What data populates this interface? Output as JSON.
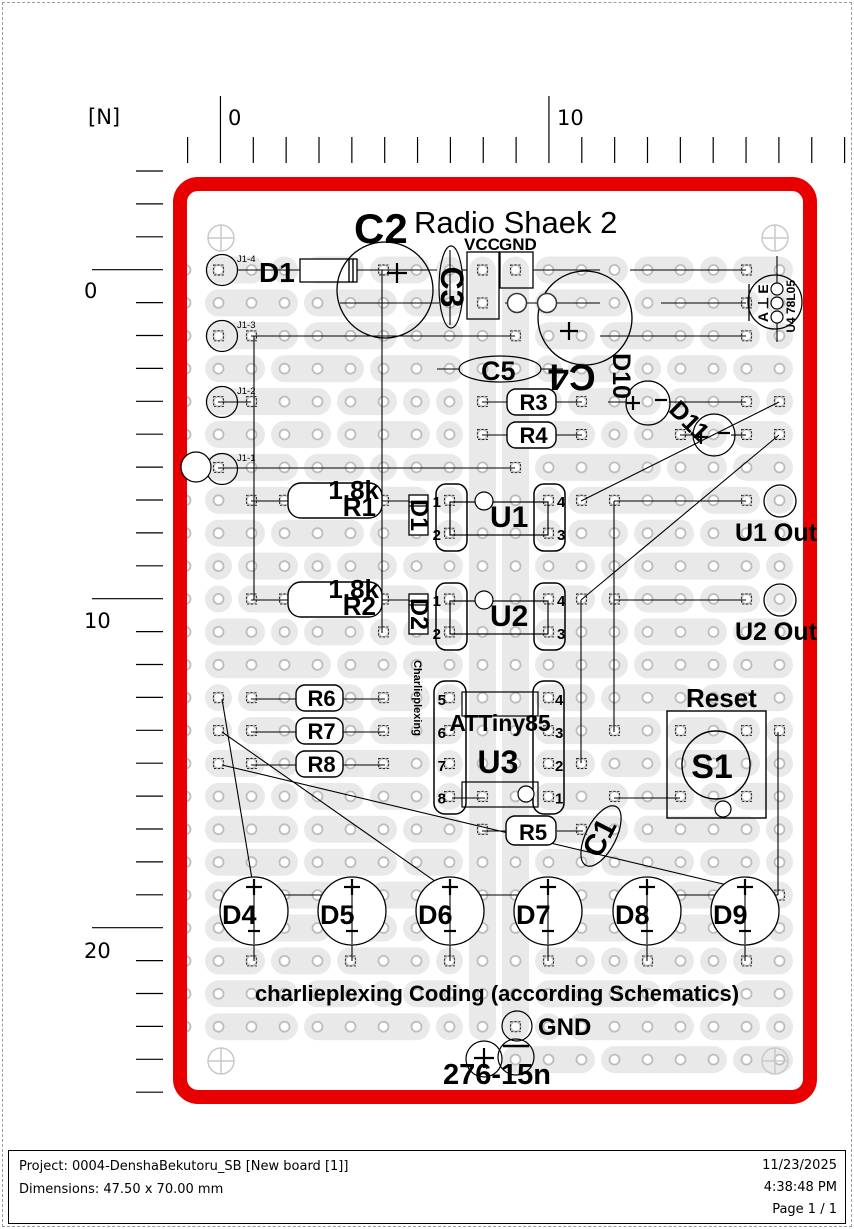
{
  "page": {
    "footer": {
      "project": "Project: 0004-DenshaBekutoru_SB [New board [1]]",
      "dimensions": "Dimensions: 47.50 x 70.00 mm",
      "date": "11/23/2025",
      "time": "4:38:48 PM",
      "page": "Page 1 / 1"
    }
  },
  "ruler": {
    "unit": "[N]",
    "top": [
      {
        "x": 221,
        "t": "0"
      },
      {
        "x": 550,
        "t": "10"
      }
    ],
    "left": [
      {
        "y": 270,
        "t": "0"
      },
      {
        "y": 600,
        "t": "10"
      },
      {
        "y": 930,
        "t": "20"
      }
    ]
  },
  "board": {
    "colors": {
      "border": "#e80000",
      "strip": "#e9e9e9",
      "hole_ring": "#bdbdbd"
    },
    "labels": [
      {
        "t": "Radio Shaek 2",
        "x": 414,
        "y": 233,
        "s": 31,
        "w": 400,
        "n": "board-title"
      },
      {
        "t": "VCC",
        "x": 464,
        "y": 250,
        "s": 17,
        "n": "vcc-header-label"
      },
      {
        "t": "GND",
        "x": 499,
        "y": 250,
        "s": 17,
        "n": "gnd-header-label"
      },
      {
        "t": "C2",
        "x": 354,
        "y": 243,
        "s": 42,
        "n": "ref-C2"
      },
      {
        "t": "C3",
        "x": 452,
        "y": 287,
        "s": 32,
        "r": 90,
        "n": "ref-C3"
      },
      {
        "t": "C5",
        "x": 481,
        "y": 380,
        "s": 27,
        "n": "ref-C5"
      },
      {
        "t": "C4",
        "x": 572,
        "y": 377,
        "s": 37,
        "r": 180,
        "n": "ref-C4"
      },
      {
        "t": "D10",
        "x": 621,
        "y": 376,
        "s": 25,
        "r": 90,
        "n": "ref-D10"
      },
      {
        "t": "D11",
        "x": 689,
        "y": 421,
        "s": 25,
        "r": 45,
        "n": "ref-D11"
      },
      {
        "t": "D1",
        "x": 259,
        "y": 282,
        "s": 28,
        "n": "ref-D1"
      },
      {
        "t": "D1",
        "x": 419,
        "y": 515,
        "s": 25,
        "r": 90,
        "n": "ref-D1-small"
      },
      {
        "t": "D2",
        "x": 419,
        "y": 614,
        "s": 25,
        "r": 90,
        "n": "ref-D2-small"
      },
      {
        "t": "C1",
        "x": 600,
        "y": 838,
        "s": 30,
        "r": -63,
        "n": "ref-C1"
      },
      {
        "t": "charlieplexing Coding (according Schematics)",
        "x": 497,
        "y": 1001,
        "s": 22,
        "a": "m",
        "n": "coding-note"
      },
      {
        "t": "GND",
        "x": 538,
        "y": 1035,
        "s": 24,
        "n": "gnd-pad-label"
      },
      {
        "t": "276-15n",
        "x": 443,
        "y": 1084,
        "s": 29,
        "n": "battery-part-label"
      }
    ],
    "resistors": [
      {
        "ref": "R1",
        "value": "1.8k",
        "x": 288,
        "y": 483,
        "w": 94,
        "h": 35,
        "big": true
      },
      {
        "ref": "R2",
        "value": "1.8k",
        "x": 288,
        "y": 582,
        "w": 94,
        "h": 35,
        "big": true
      },
      {
        "ref": "R3",
        "x": 507,
        "y": 389,
        "w": 49,
        "h": 26
      },
      {
        "ref": "R4",
        "x": 507,
        "y": 422,
        "w": 49,
        "h": 26
      },
      {
        "ref": "R5",
        "x": 506,
        "y": 816,
        "w": 50,
        "h": 29
      },
      {
        "ref": "R6",
        "x": 296,
        "y": 685,
        "w": 47,
        "h": 26
      },
      {
        "ref": "R7",
        "x": 296,
        "y": 718,
        "w": 47,
        "h": 26
      },
      {
        "ref": "R8",
        "x": 296,
        "y": 751,
        "w": 47,
        "h": 26
      }
    ],
    "dips": [
      {
        "ref": "U1",
        "y": 484,
        "pins": [
          "1",
          "2",
          "4",
          "3"
        ]
      },
      {
        "ref": "U2",
        "y": 583,
        "pins": [
          "1",
          "2",
          "4",
          "3"
        ]
      }
    ],
    "u3": {
      "ref": "U3",
      "part": "ATTiny85",
      "left_pins": [
        "5",
        "6",
        "7",
        "8"
      ],
      "right_pins": [
        "4",
        "3",
        "2",
        "1"
      ],
      "side_label": "Charlieplexing"
    },
    "switch": {
      "ref": "S1",
      "label": "Reset"
    },
    "regulator": {
      "ref": "U4",
      "part": "78L05",
      "pins": [
        "E",
        "⊥",
        "A"
      ]
    },
    "leds": [
      {
        "ref": "D4",
        "cx": 254
      },
      {
        "ref": "D5",
        "cx": 352
      },
      {
        "ref": "D6",
        "cx": 450
      },
      {
        "ref": "D7",
        "cx": 548
      },
      {
        "ref": "D8",
        "cx": 647
      },
      {
        "ref": "D9",
        "cx": 745
      }
    ],
    "connector_pads": [
      {
        "label": "J1-4",
        "y": 270
      },
      {
        "label": "J1-3",
        "y": 336
      },
      {
        "label": "J1-2",
        "y": 402
      },
      {
        "label": "J1-1",
        "y": 469
      }
    ],
    "outputs": [
      {
        "label": "U1 Out",
        "cy": 501
      },
      {
        "label": "U2 Out",
        "cy": 600
      }
    ]
  }
}
